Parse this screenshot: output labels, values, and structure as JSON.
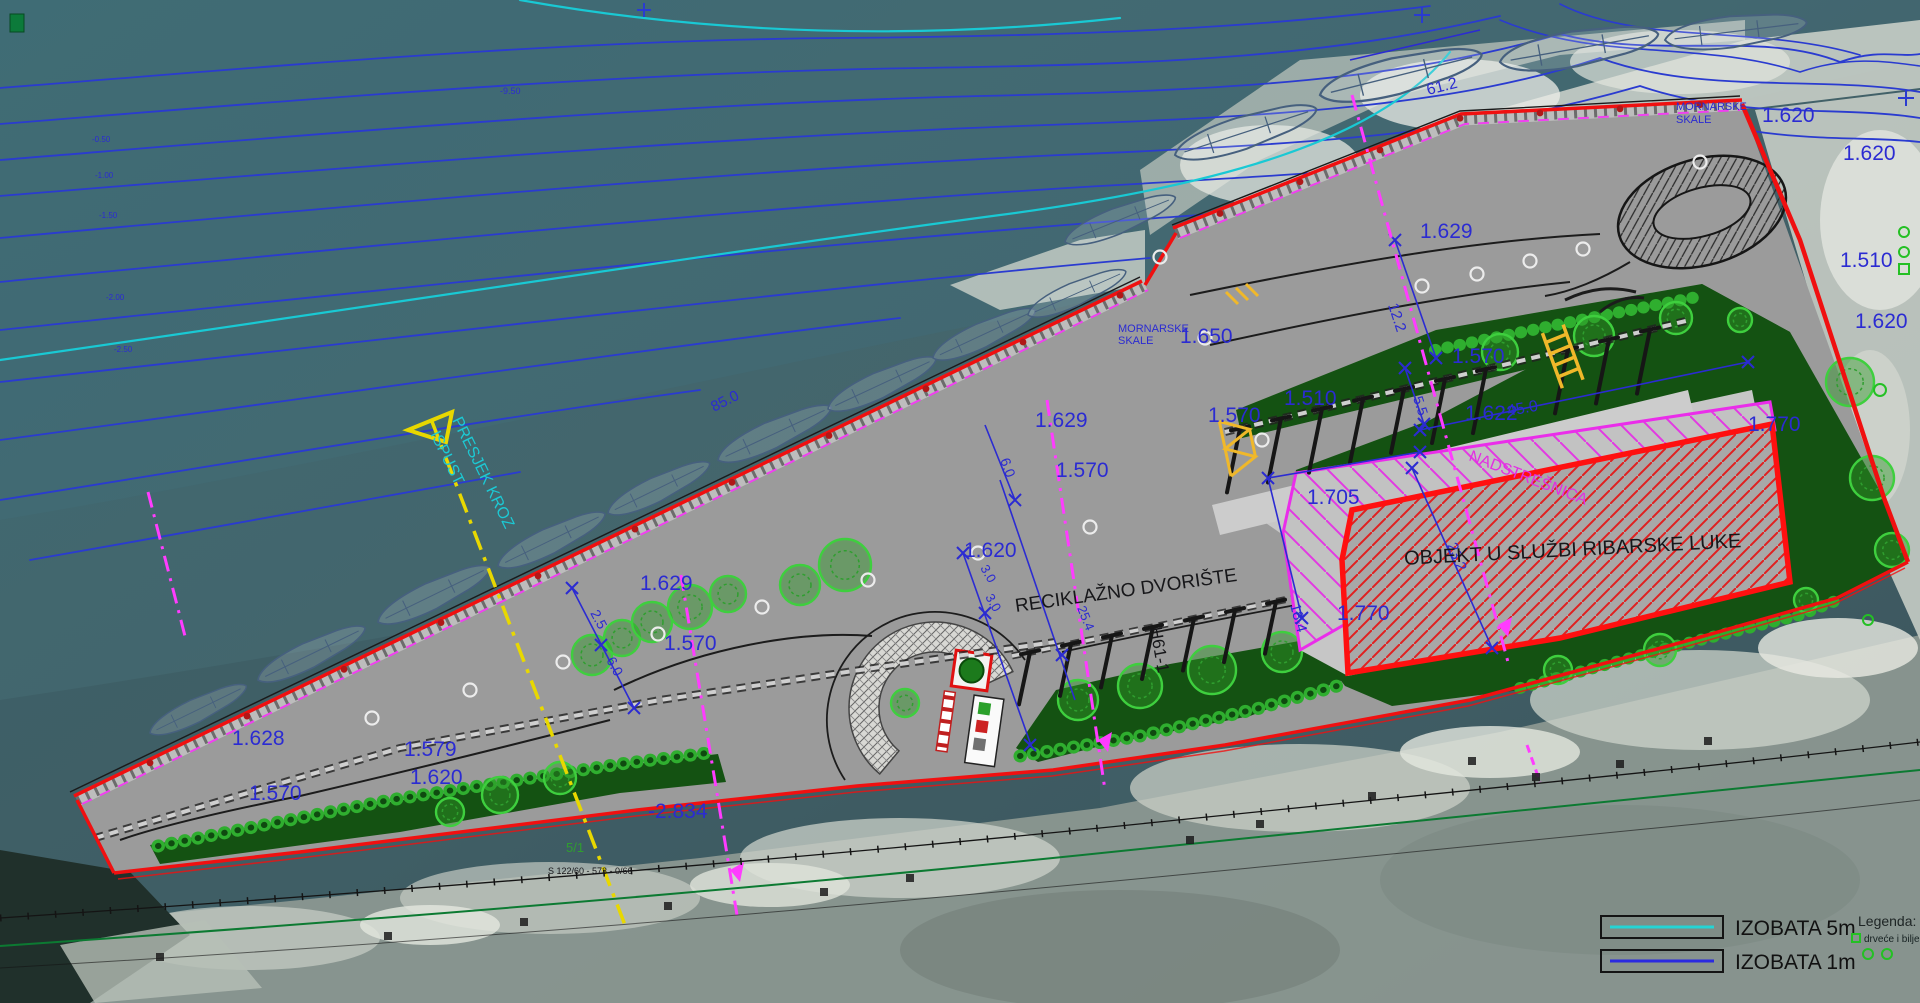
{
  "title": "Situacija - ribarska luka (site plan)",
  "colors": {
    "elev": "#2b2bd2",
    "dim": "#2b2bd2",
    "black": "#17171a",
    "magenta": "#e32de3",
    "cyan": "#1cc9d4",
    "green": "#2f9e2f",
    "blue_small": "#2b2bd2",
    "isobath5": "#25d4d4",
    "isobath1": "#2a2ae0",
    "boundary_red": "#f01010",
    "canopy_magenta": "#e838e8",
    "section_yellow": "#e8d800"
  },
  "legend": {
    "title": "Legenda:",
    "items": [
      {
        "label": "IZOBATA 5m",
        "line_color": "#25d4d4"
      },
      {
        "label": "IZOBATA 1m",
        "line_color": "#2a2ae0"
      }
    ],
    "note": "drveće i bilje"
  },
  "annotations": {
    "labels": [
      {
        "x": 232,
        "y": 745,
        "t": "1.628"
      },
      {
        "x": 249,
        "y": 800,
        "t": "1.570"
      },
      {
        "x": 404,
        "y": 756,
        "t": "1.579"
      },
      {
        "x": 410,
        "y": 784,
        "t": "1.620"
      },
      {
        "x": 640,
        "y": 590,
        "t": "1.629"
      },
      {
        "x": 664,
        "y": 650,
        "t": "1.570"
      },
      {
        "x": 648,
        "y": 818,
        "t": "-2.834"
      },
      {
        "x": 1035,
        "y": 427,
        "t": "1.629"
      },
      {
        "x": 1208,
        "y": 422,
        "t": "1.570"
      },
      {
        "x": 1180,
        "y": 343,
        "t": "1.650"
      },
      {
        "x": 1056,
        "y": 477,
        "t": "1.570"
      },
      {
        "x": 964,
        "y": 557,
        "t": "1.620"
      },
      {
        "x": 1420,
        "y": 238,
        "t": "1.629"
      },
      {
        "x": 1452,
        "y": 363,
        "t": "1.570"
      },
      {
        "x": 1465,
        "y": 420,
        "t": "1.622"
      },
      {
        "x": 1284,
        "y": 405,
        "t": "1.510"
      },
      {
        "x": 1307,
        "y": 504,
        "t": "1.705"
      },
      {
        "x": 1337,
        "y": 620,
        "t": "1.770"
      },
      {
        "x": 1748,
        "y": 431,
        "t": "1.770"
      },
      {
        "x": 1840,
        "y": 267,
        "t": "1.510"
      },
      {
        "x": 1855,
        "y": 328,
        "t": "1.620"
      },
      {
        "x": 1762,
        "y": 122,
        "t": "1.620"
      },
      {
        "x": 1843,
        "y": 160,
        "t": "1.620"
      },
      {
        "x": 1428,
        "y": 95,
        "t": "61.2",
        "s": 16,
        "r": -14
      },
      {
        "x": 714,
        "y": 412,
        "t": "85.0",
        "s": 15,
        "r": -27
      },
      {
        "x": 1388,
        "y": 305,
        "t": "12.2",
        "s": 15,
        "r": 72
      },
      {
        "x": 1413,
        "y": 398,
        "t": "5.5",
        "s": 14,
        "r": 72
      },
      {
        "x": 1508,
        "y": 416,
        "t": "45.0",
        "s": 16,
        "r": -10
      },
      {
        "x": 1447,
        "y": 545,
        "t": "23.2",
        "s": 15,
        "r": 68
      },
      {
        "x": 1290,
        "y": 605,
        "t": "18.4",
        "s": 15,
        "r": 75
      },
      {
        "x": 1000,
        "y": 460,
        "t": "6.0",
        "s": 14,
        "r": 70
      },
      {
        "x": 590,
        "y": 613,
        "t": "2.5",
        "s": 14,
        "r": 62
      },
      {
        "x": 606,
        "y": 660,
        "t": "6.0",
        "s": 14,
        "r": 62
      },
      {
        "x": 980,
        "y": 568,
        "t": "3.0",
        "s": 13,
        "r": 60
      },
      {
        "x": 985,
        "y": 597,
        "t": "3.0",
        "s": 13,
        "r": 60
      },
      {
        "x": 1077,
        "y": 608,
        "t": "25.4",
        "s": 13,
        "r": 68
      },
      {
        "x": 1016,
        "y": 612,
        "t": "RECIKLAŽNO DVORIŠTE",
        "c": "black",
        "s": 19,
        "f": "serif",
        "r": -8
      },
      {
        "x": 1573,
        "y": 556,
        "t": "OBJEKT U SLUŽBI RIBARSKE LUKE",
        "c": "black",
        "s": 20,
        "f": "serif",
        "r": -3,
        "a": "middle"
      },
      {
        "x": 1468,
        "y": 460,
        "t": "NADSTREŠNICA",
        "c": "magenta",
        "s": 16,
        "f": "serif",
        "r": 21
      },
      {
        "x": 1150,
        "y": 628,
        "t": "H61-1",
        "c": "black",
        "s": 17,
        "r": 80
      },
      {
        "x": 452,
        "y": 420,
        "t": "PRESJEK KROZ",
        "c": "cyan",
        "s": 16,
        "r": 64
      },
      {
        "x": 430,
        "y": 434,
        "t": "ISPUST",
        "c": "cyan",
        "s": 16,
        "r": 64
      },
      {
        "x": 1676,
        "y": 110,
        "t": "MORNARSKE",
        "c": "blue_small",
        "s": 11
      },
      {
        "x": 1676,
        "y": 123,
        "t": "SKALE",
        "c": "blue_small",
        "s": 11
      },
      {
        "x": 1118,
        "y": 332,
        "t": "MORNARSKE",
        "c": "blue_small",
        "s": 11
      },
      {
        "x": 1118,
        "y": 344,
        "t": "SKALE",
        "c": "blue_small",
        "s": 11
      },
      {
        "x": 566,
        "y": 852,
        "t": "5/1",
        "c": "green",
        "s": 13
      },
      {
        "x": 548,
        "y": 874,
        "t": "S 122/60 - 573 - 0/66",
        "c": "black",
        "s": 9
      },
      {
        "x": 500,
        "y": 94,
        "t": "-9.50",
        "c": "blue_small",
        "s": 9
      },
      {
        "x": 92,
        "y": 142,
        "t": "-0.50",
        "c": "blue_small",
        "s": 8
      },
      {
        "x": 95,
        "y": 178,
        "t": "-1.00",
        "c": "blue_small",
        "s": 8
      },
      {
        "x": 99,
        "y": 218,
        "t": "-1.50",
        "c": "blue_small",
        "s": 8
      },
      {
        "x": 106,
        "y": 300,
        "t": "-2.00",
        "c": "blue_small",
        "s": 8
      },
      {
        "x": 114,
        "y": 352,
        "t": "-2.50",
        "c": "blue_small",
        "s": 8
      }
    ]
  }
}
